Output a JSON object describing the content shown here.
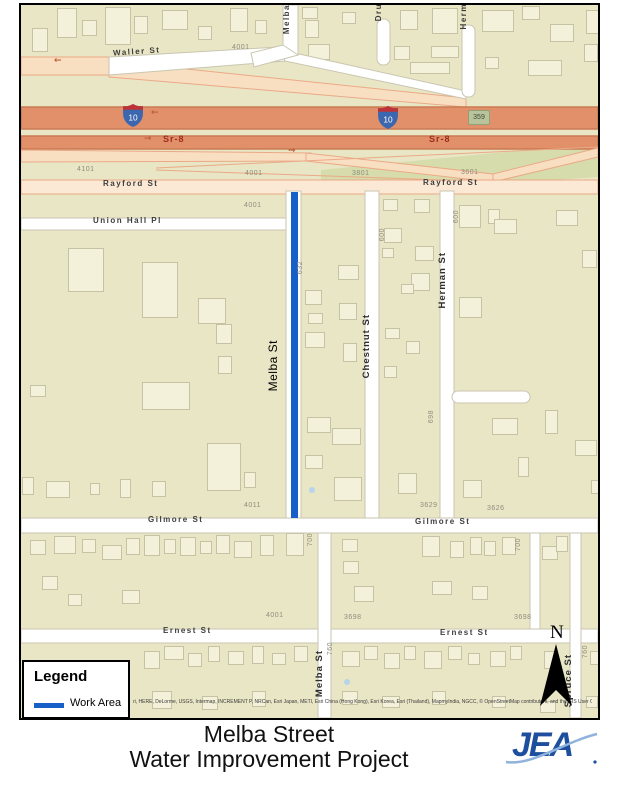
{
  "title": {
    "line1": "Melba Street",
    "line2": "Water Improvement Project"
  },
  "logo": {
    "text": "JEA"
  },
  "legend": {
    "title": "Legend",
    "items": [
      {
        "label": "Work Area",
        "color": "#1660c8"
      }
    ]
  },
  "map": {
    "background": "#e9e6c6",
    "work_area_color": "#1660c8",
    "north_label": "N",
    "attribution": "ri, HERE, DeLorme, USGS, Intermap, INCREMENT P, NRCan, Esri Japan, METI, Esri China (Hong Kong), Esri Korea, Esri (Thailand), MapmyIndia, NGCC, © OpenStreetMap contributors, and the GIS User Community",
    "highways": {
      "interstate_shield": "10",
      "state_route": "Sr-8",
      "exit_badge": "359"
    },
    "street_labels": {
      "waller": "Waller St",
      "rayford_left": "Rayford St",
      "rayford_right": "Rayford St",
      "union_hall": "Union Hall Pl",
      "melba_top": "Melba",
      "dru": "Dru",
      "herm": "Herm",
      "melba_main": "Melba St",
      "chestnut": "Chestnut St",
      "herman": "Herman St",
      "gilmore_left": "Gilmore St",
      "gilmore_right": "Gilmore St",
      "ernest_left": "Ernest St",
      "ernest_right": "Ernest St",
      "melba_lower": "Melba St",
      "spruce": "Spruce St",
      "sr8_left": "Sr-8",
      "sr8_right": "Sr-8"
    },
    "addresses": [
      {
        "t": "4001",
        "x": 232,
        "y": 44,
        "v": false
      },
      {
        "t": "4101",
        "x": 77,
        "y": 166,
        "v": false
      },
      {
        "t": "4001",
        "x": 245,
        "y": 170,
        "v": false
      },
      {
        "t": "3801",
        "x": 352,
        "y": 170,
        "v": false
      },
      {
        "t": "3601",
        "x": 461,
        "y": 169,
        "v": false
      },
      {
        "t": "4001",
        "x": 244,
        "y": 202,
        "v": false
      },
      {
        "t": "632",
        "x": 297,
        "y": 261,
        "v": true
      },
      {
        "t": "600",
        "x": 379,
        "y": 228,
        "v": true
      },
      {
        "t": "600",
        "x": 453,
        "y": 210,
        "v": true
      },
      {
        "t": "698",
        "x": 428,
        "y": 410,
        "v": true
      },
      {
        "t": "4011",
        "x": 244,
        "y": 502,
        "v": false
      },
      {
        "t": "3629",
        "x": 420,
        "y": 502,
        "v": false
      },
      {
        "t": "3626",
        "x": 487,
        "y": 505,
        "v": false
      },
      {
        "t": "700",
        "x": 307,
        "y": 533,
        "v": true
      },
      {
        "t": "700",
        "x": 515,
        "y": 538,
        "v": true
      },
      {
        "t": "4001",
        "x": 266,
        "y": 612,
        "v": false
      },
      {
        "t": "3698",
        "x": 344,
        "y": 614,
        "v": false
      },
      {
        "t": "3698",
        "x": 514,
        "y": 614,
        "v": false
      },
      {
        "t": "760",
        "x": 327,
        "y": 642,
        "v": true
      },
      {
        "t": "760",
        "x": 582,
        "y": 645,
        "v": true
      }
    ],
    "arrows": [
      {
        "g": "←",
        "x": 54,
        "y": 56
      },
      {
        "g": "←",
        "x": 151,
        "y": 108
      },
      {
        "g": "→",
        "x": 144,
        "y": 134
      },
      {
        "g": "→",
        "x": 288,
        "y": 146
      }
    ],
    "buildings": [
      [
        30,
        26,
        16,
        24
      ],
      [
        55,
        6,
        20,
        30
      ],
      [
        80,
        18,
        15,
        16
      ],
      [
        103,
        5,
        26,
        38
      ],
      [
        132,
        14,
        14,
        18
      ],
      [
        160,
        8,
        26,
        20
      ],
      [
        196,
        24,
        14,
        14
      ],
      [
        228,
        6,
        18,
        24
      ],
      [
        253,
        18,
        12,
        14
      ],
      [
        300,
        5,
        16,
        12
      ],
      [
        303,
        18,
        14,
        18
      ],
      [
        306,
        42,
        22,
        16
      ],
      [
        340,
        10,
        14,
        12
      ],
      [
        392,
        44,
        16,
        14
      ],
      [
        398,
        8,
        18,
        20
      ],
      [
        430,
        6,
        26,
        26
      ],
      [
        429,
        44,
        28,
        12
      ],
      [
        480,
        8,
        32,
        22
      ],
      [
        483,
        55,
        14,
        12
      ],
      [
        520,
        4,
        18,
        14
      ],
      [
        526,
        58,
        34,
        16
      ],
      [
        548,
        22,
        24,
        18
      ],
      [
        584,
        8,
        14,
        24
      ],
      [
        582,
        42,
        14,
        18
      ],
      [
        408,
        60,
        40,
        12
      ],
      [
        66,
        246,
        36,
        44
      ],
      [
        140,
        260,
        36,
        56
      ],
      [
        196,
        296,
        28,
        26
      ],
      [
        214,
        322,
        16,
        20
      ],
      [
        216,
        354,
        14,
        18
      ],
      [
        28,
        383,
        16,
        12
      ],
      [
        140,
        380,
        48,
        28
      ],
      [
        205,
        441,
        34,
        48
      ],
      [
        20,
        475,
        12,
        18
      ],
      [
        44,
        479,
        24,
        17
      ],
      [
        88,
        481,
        10,
        12
      ],
      [
        118,
        477,
        11,
        19
      ],
      [
        150,
        479,
        14,
        16
      ],
      [
        242,
        470,
        12,
        16
      ],
      [
        303,
        288,
        17,
        15
      ],
      [
        336,
        263,
        21,
        15
      ],
      [
        337,
        301,
        18,
        17
      ],
      [
        306,
        311,
        15,
        11
      ],
      [
        303,
        330,
        20,
        16
      ],
      [
        341,
        341,
        14,
        19
      ],
      [
        305,
        415,
        24,
        16
      ],
      [
        330,
        426,
        29,
        17
      ],
      [
        332,
        475,
        28,
        24
      ],
      [
        303,
        453,
        18,
        14
      ],
      [
        381,
        197,
        15,
        12
      ],
      [
        412,
        197,
        16,
        14
      ],
      [
        382,
        226,
        18,
        15
      ],
      [
        413,
        244,
        19,
        15
      ],
      [
        380,
        246,
        12,
        10
      ],
      [
        409,
        271,
        19,
        18
      ],
      [
        399,
        282,
        13,
        10
      ],
      [
        383,
        326,
        15,
        11
      ],
      [
        404,
        339,
        14,
        13
      ],
      [
        382,
        364,
        13,
        12
      ],
      [
        396,
        471,
        19,
        21
      ],
      [
        457,
        203,
        22,
        23
      ],
      [
        486,
        207,
        12,
        15
      ],
      [
        492,
        217,
        23,
        15
      ],
      [
        457,
        295,
        23,
        21
      ],
      [
        490,
        416,
        26,
        17
      ],
      [
        516,
        455,
        11,
        20
      ],
      [
        461,
        478,
        19,
        18
      ],
      [
        543,
        408,
        13,
        24
      ],
      [
        554,
        208,
        22,
        16
      ],
      [
        580,
        248,
        15,
        18
      ],
      [
        573,
        438,
        22,
        16
      ],
      [
        589,
        478,
        10,
        14
      ],
      [
        28,
        538,
        16,
        15
      ],
      [
        52,
        534,
        22,
        18
      ],
      [
        80,
        537,
        14,
        14
      ],
      [
        100,
        543,
        20,
        15
      ],
      [
        124,
        536,
        14,
        17
      ],
      [
        142,
        533,
        16,
        21
      ],
      [
        162,
        537,
        12,
        15
      ],
      [
        178,
        535,
        16,
        19
      ],
      [
        198,
        539,
        12,
        13
      ],
      [
        214,
        533,
        14,
        19
      ],
      [
        232,
        539,
        18,
        17
      ],
      [
        258,
        533,
        14,
        21
      ],
      [
        284,
        531,
        18,
        23
      ],
      [
        40,
        574,
        16,
        14
      ],
      [
        120,
        588,
        18,
        14
      ],
      [
        66,
        592,
        14,
        12
      ],
      [
        340,
        537,
        16,
        13
      ],
      [
        341,
        559,
        16,
        13
      ],
      [
        352,
        584,
        20,
        16
      ],
      [
        420,
        534,
        18,
        21
      ],
      [
        448,
        539,
        14,
        17
      ],
      [
        468,
        535,
        12,
        18
      ],
      [
        482,
        539,
        12,
        15
      ],
      [
        500,
        535,
        14,
        18
      ],
      [
        430,
        579,
        20,
        14
      ],
      [
        470,
        584,
        16,
        14
      ],
      [
        540,
        544,
        16,
        14
      ],
      [
        554,
        534,
        12,
        16
      ],
      [
        142,
        649,
        16,
        18
      ],
      [
        162,
        644,
        20,
        14
      ],
      [
        186,
        651,
        14,
        14
      ],
      [
        206,
        644,
        12,
        16
      ],
      [
        226,
        649,
        16,
        14
      ],
      [
        250,
        644,
        12,
        18
      ],
      [
        270,
        651,
        14,
        12
      ],
      [
        150,
        689,
        20,
        18
      ],
      [
        200,
        694,
        16,
        14
      ],
      [
        250,
        689,
        14,
        16
      ],
      [
        292,
        644,
        14,
        16
      ],
      [
        340,
        649,
        18,
        16
      ],
      [
        362,
        644,
        14,
        14
      ],
      [
        382,
        651,
        16,
        16
      ],
      [
        402,
        644,
        12,
        14
      ],
      [
        422,
        649,
        18,
        18
      ],
      [
        446,
        644,
        14,
        14
      ],
      [
        466,
        651,
        12,
        12
      ],
      [
        340,
        689,
        16,
        14
      ],
      [
        380,
        694,
        18,
        12
      ],
      [
        430,
        689,
        14,
        14
      ],
      [
        488,
        649,
        16,
        16
      ],
      [
        508,
        644,
        12,
        14
      ],
      [
        542,
        649,
        14,
        18
      ],
      [
        588,
        649,
        10,
        14
      ],
      [
        490,
        694,
        14,
        12
      ],
      [
        538,
        699,
        16,
        12
      ],
      [
        584,
        694,
        12,
        12
      ]
    ]
  }
}
